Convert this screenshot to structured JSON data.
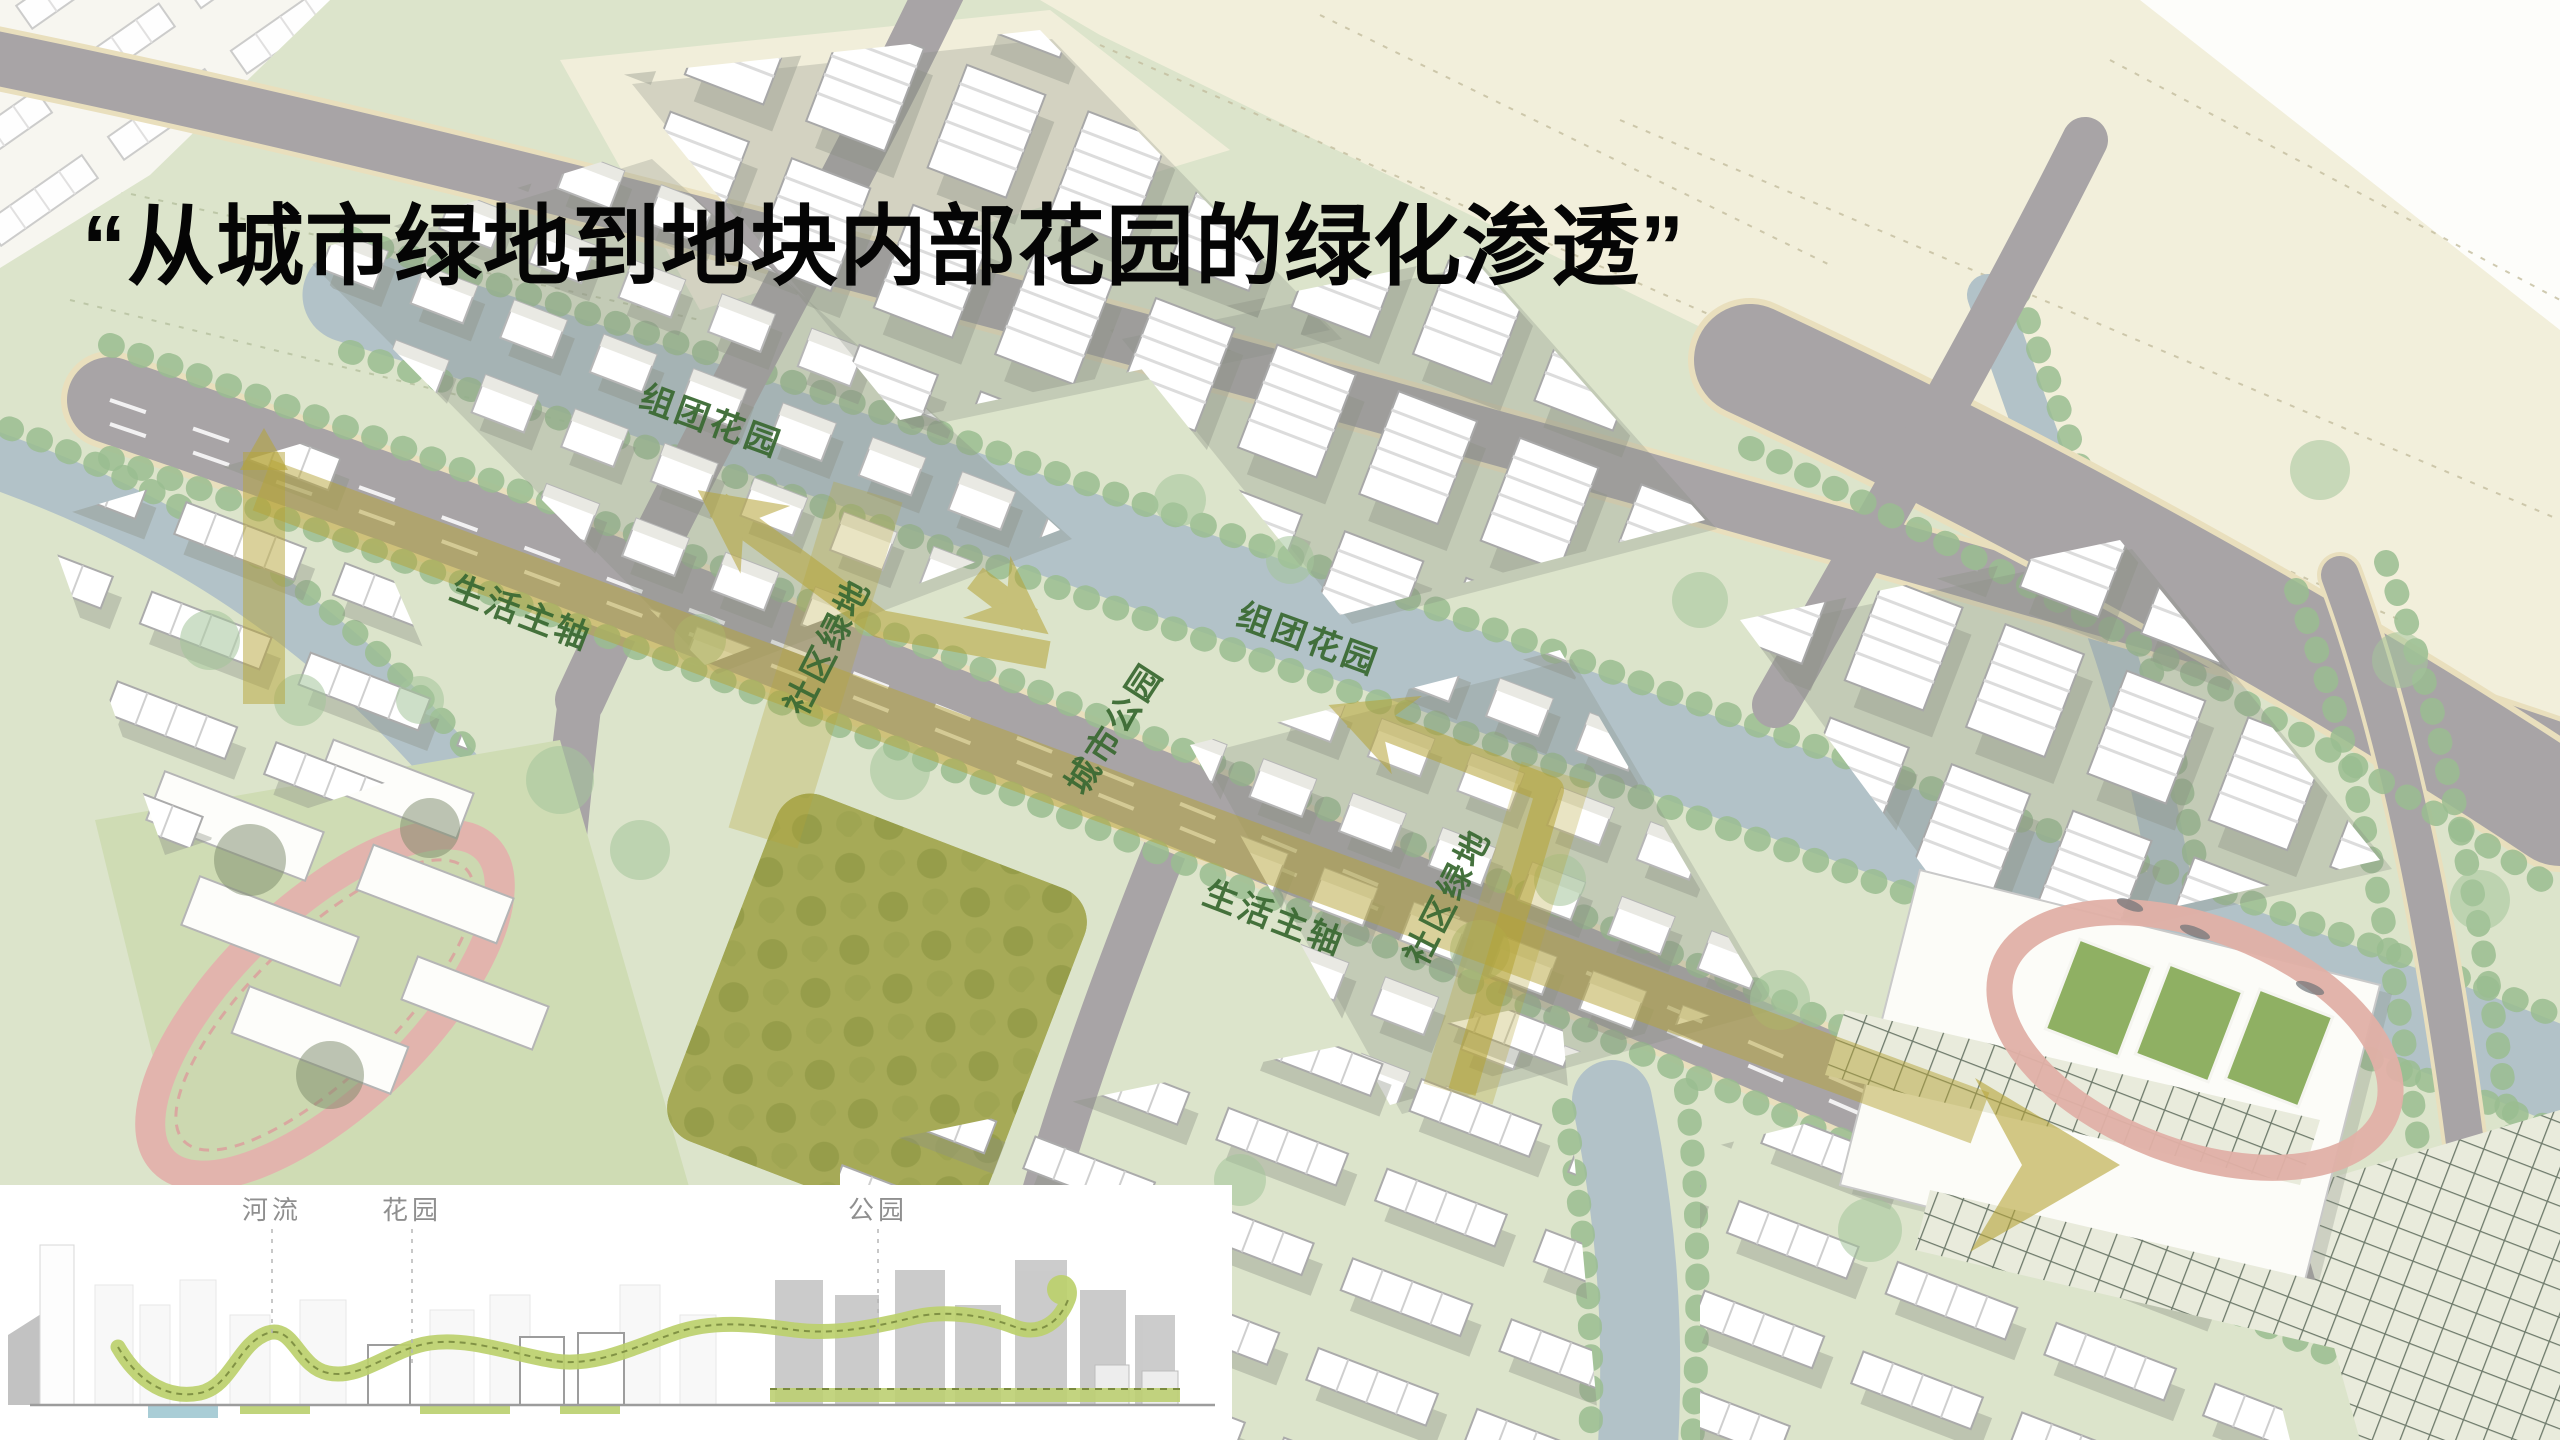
{
  "slide": {
    "title": "“从城市绿地到地块内部花园的绿化渗透”"
  },
  "map": {
    "labels": [
      {
        "id": "cluster-garden-1",
        "text": "组团花园"
      },
      {
        "id": "life-axis-1",
        "text": "生活主轴"
      },
      {
        "id": "community-green-1",
        "text": "社区绿地"
      },
      {
        "id": "city-park",
        "text": "城市公园"
      },
      {
        "id": "cluster-garden-2",
        "text": "组团花园"
      },
      {
        "id": "life-axis-2",
        "text": "生活主轴"
      },
      {
        "id": "community-green-2",
        "text": "社区绿地"
      }
    ],
    "colors": {
      "axis_highlight": "#b5a437",
      "label_green": "#3c6b34",
      "water": "#b2c2c8",
      "road": "#a8a4a6",
      "farmland": "#f2efdb",
      "greenland": "#dce4cb",
      "park_olive": "#a3ab5f",
      "track_pink": "#e2b4ad",
      "building_white": "#ffffff"
    }
  },
  "section_inset": {
    "labels": [
      {
        "id": "river",
        "text": "河流"
      },
      {
        "id": "garden",
        "text": "花园"
      },
      {
        "id": "park",
        "text": "公园"
      }
    ]
  }
}
